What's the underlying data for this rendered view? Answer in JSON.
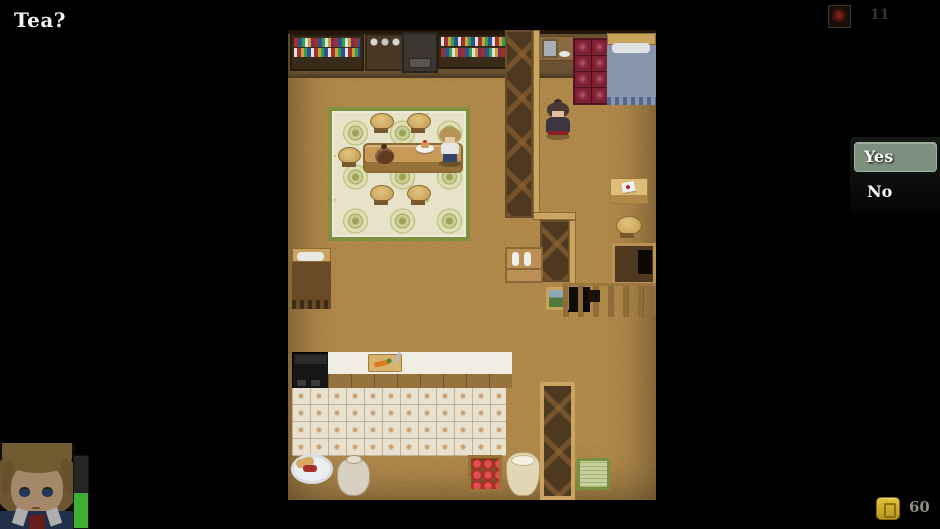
{
  "dialogue": {
    "text": "Tea?"
  },
  "choice_window": {
    "options": [
      {
        "label": "Yes",
        "selected": true
      },
      {
        "label": "No",
        "selected": false
      }
    ],
    "highlight_color": "#7d8f7d"
  },
  "hud": {
    "item_counter": {
      "icon": "red-herb-item-icon",
      "count": "11"
    },
    "gold_counter": {
      "icon": "gold-coin-icon",
      "amount": "60"
    },
    "player_status": {
      "portrait": "hero-portrait",
      "hp_percent": 48,
      "hp_color": "#3fae35"
    }
  },
  "map": {
    "name": "cottage-interior",
    "scene_objects": [
      "bookshelves",
      "dish-cabinet",
      "washstand",
      "red-folding-screen",
      "bed",
      "old-woman-npc",
      "tea-table",
      "teapot",
      "cake-plate",
      "stools",
      "floral-carpet",
      "partition-wall",
      "letter-desk",
      "wall-picture",
      "kitchen-counter",
      "stove",
      "cutting-board",
      "tiled-floor",
      "bread-plate",
      "pot",
      "apple-crate",
      "flour-sack",
      "straw-mat",
      "player-character"
    ]
  }
}
